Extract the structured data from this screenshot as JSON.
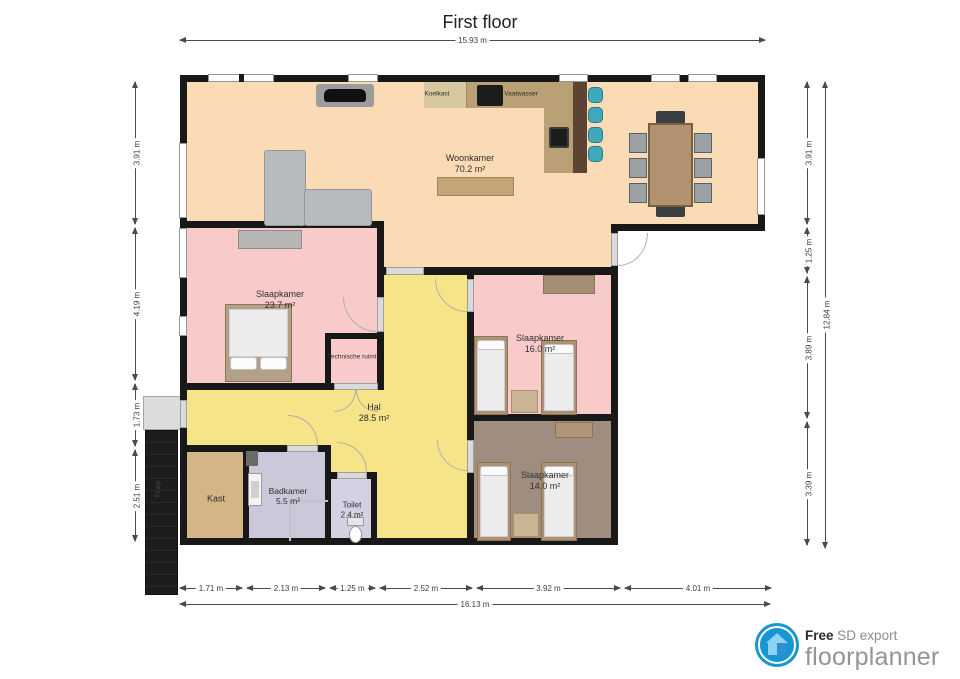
{
  "title": "First floor",
  "rooms": {
    "woonkamer": {
      "name": "Woonkamer",
      "area": "70.2 m²"
    },
    "slaapkamer_groot": {
      "name": "Slaapkamer",
      "area": "23.7 m²"
    },
    "slaapkamer_midden": {
      "name": "Slaapkamer",
      "area": "16.0 m²"
    },
    "slaapkamer_onder": {
      "name": "Slaapkamer",
      "area": "14.0 m²"
    },
    "hal": {
      "name": "Hal",
      "area": "28.5 m²"
    },
    "badkamer": {
      "name": "Badkamer",
      "area": "5.5 m²"
    },
    "toilet": {
      "name": "Toilet",
      "area": "2.4 m²"
    },
    "kast": {
      "name": "Kast"
    },
    "technische_ruimte": {
      "name": "Technische ruimte"
    },
    "trap": {
      "name": "Trap"
    }
  },
  "appliances": {
    "koelkast": "Koelkast",
    "vaatwasser": "Vaatwasser"
  },
  "dimensions": {
    "top_total": "15.93 m",
    "bottom_segments": [
      "1.71 m",
      "2.13 m",
      "1.25 m",
      "2.52 m",
      "3.92 m",
      "4.01 m"
    ],
    "bottom_total": "16.13 m",
    "left_segments": [
      "3.91 m",
      "4.19 m",
      "1.73 m",
      "2.51 m"
    ],
    "right_segments": [
      "3.91 m",
      "1.25 m",
      "3.89 m",
      "3.39 m"
    ],
    "right_total": "12.84 m"
  },
  "footer": {
    "free": "Free",
    "export_label": "SD export",
    "brand": "floorplanner"
  },
  "colors": {
    "woonkamer_floor": "#fadbb5",
    "bedroom_floor": "#f8caca",
    "hal_floor": "#f7e388",
    "bedroom3_floor": "#9f8e80",
    "kast_floor": "#d5b487",
    "badkamer_floor": "#c9c9da",
    "wall": "#181818",
    "brand_blue": "#1797d2"
  }
}
